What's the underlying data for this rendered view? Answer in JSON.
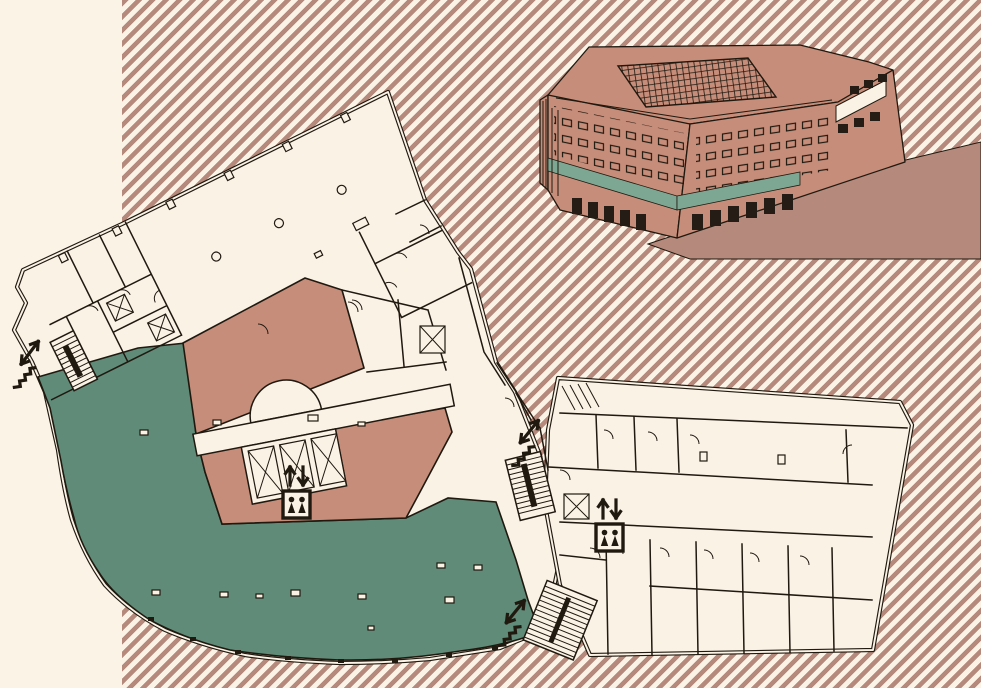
{
  "document": {
    "type": "architectural floor plan with axonometric building view",
    "title": "Building floor plan"
  },
  "palette": {
    "background": "#fcf3e7",
    "stripe": "#b5897b",
    "paper": "#fbf2e6",
    "zone_green": "#5f8b78",
    "zone_brown": "#c68d7a",
    "illustration_green": "#7ea793",
    "line": "#20190f",
    "dark_glass": "#241c15"
  },
  "zones": [
    {
      "id": "green-zone",
      "description": "highlighted level area (curved glass front)",
      "color": "#5f8b78"
    },
    {
      "id": "brown-zone",
      "description": "central core / lobby area",
      "color": "#c68d7a"
    },
    {
      "id": "office-areas",
      "description": "unhighlighted office rooms",
      "color": "#fbf2e6"
    }
  ],
  "icons": {
    "elevator": {
      "label": "elevator with up-down arrows",
      "count": 2
    },
    "stairs": {
      "label": "stairs with up-down arrow",
      "count": 3
    }
  }
}
